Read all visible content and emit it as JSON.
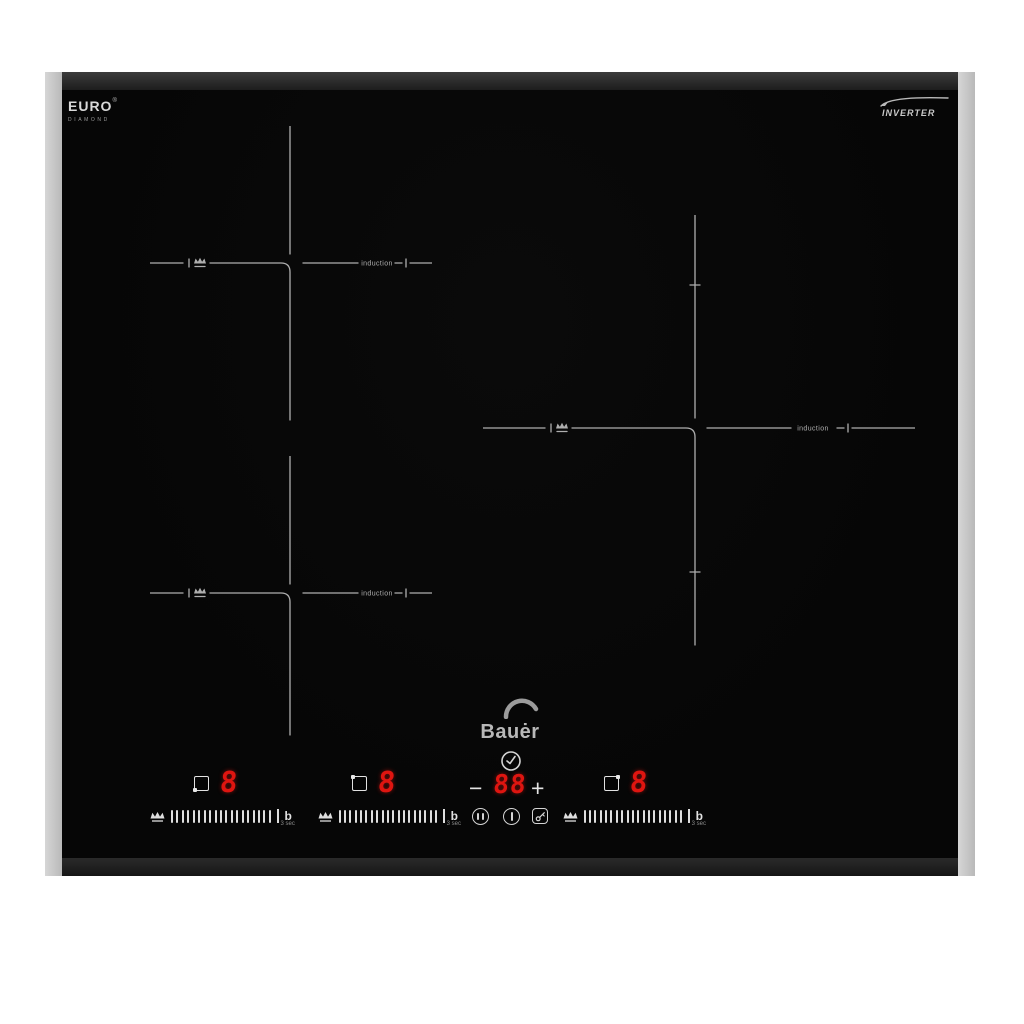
{
  "branding": {
    "euro": {
      "name": "EURO",
      "reg": "®",
      "sub": "DIAMOND"
    },
    "inverter": "INVERTER",
    "bauer": "Bauėr"
  },
  "zones": [
    {
      "id": "rear-left",
      "label": "induction"
    },
    {
      "id": "front-left",
      "label": "induction"
    },
    {
      "id": "right",
      "label": "induction"
    }
  ],
  "panel": {
    "displays": [
      {
        "zone": "front-left",
        "level": "8"
      },
      {
        "zone": "rear-left",
        "level": "8"
      },
      {
        "zone": "right",
        "level": "8"
      }
    ],
    "slider": {
      "ticks": 19,
      "boost": "b",
      "boost_note": "3 sec"
    },
    "timer": {
      "minus": "−",
      "value": "88",
      "plus": "+"
    }
  },
  "colors": {
    "background": "#ffffff",
    "glass": "#070707",
    "frame_side": "#c6c6c6",
    "frame_edge": "#2c2c2c",
    "marking": "#aeaeae",
    "display_red": "#de1510"
  }
}
